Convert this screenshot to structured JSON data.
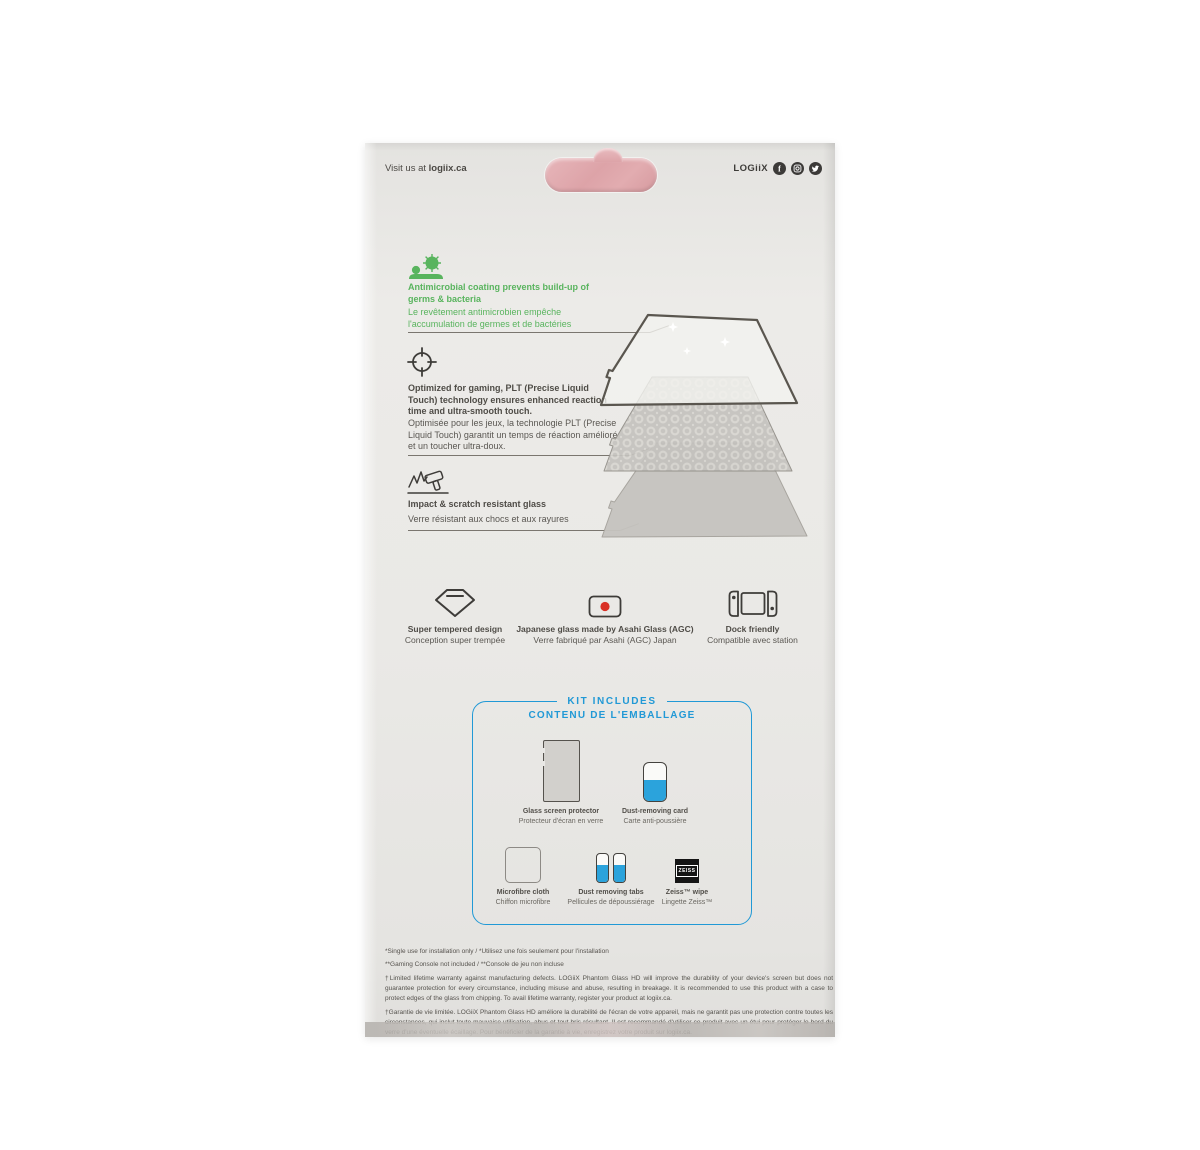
{
  "header": {
    "visit_prefix": "Visit us at ",
    "visit_bold": "logiix.ca",
    "brand": "LOGiiX",
    "social_icons": [
      "facebook-icon",
      "instagram-icon",
      "twitter-icon"
    ]
  },
  "hang_tab": {
    "shape": "pink die-cut hang tab",
    "color": "#dda3a8"
  },
  "features": [
    {
      "icon": "germs-icon",
      "en": "Antimicrobial coating prevents build-up of germs & bacteria",
      "fr": "Le revêtement antimicrobien empêche l'accumulation de germes et de bactéries"
    },
    {
      "icon": "crosshair-icon",
      "en": "Optimized for gaming, PLT (Precise Liquid Touch) technology ensures enhanced reaction time and ultra-smooth touch.",
      "fr": "Optimisée pour les jeux, la technologie PLT (Precise Liquid Touch) garantit un temps de réaction amélioré et un toucher ultra-doux."
    },
    {
      "icon": "impact-hammer-icon",
      "en": "Impact & scratch resistant glass",
      "fr": "Verre résistant aux chocs et aux rayures"
    }
  ],
  "diagram": {
    "description": "three stacked glass layers in perspective",
    "layers": [
      "clear top glass with sparkles",
      "patterned adhesive layer",
      "base glass layer"
    ]
  },
  "badges": [
    {
      "icon": "diamond-icon",
      "en": "Super tempered design",
      "fr": "Conception super trempée"
    },
    {
      "icon": "japan-flag-icon",
      "en": "Japanese glass made by Asahi Glass (AGC)",
      "fr": "Verre fabriqué par Asahi (AGC) Japan"
    },
    {
      "icon": "switch-dock-icon",
      "en": "Dock friendly",
      "fr": "Compatible avec station"
    }
  ],
  "kit": {
    "title_en": "KIT INCLUDES",
    "title_fr": "CONTENU DE L'EMBALLAGE",
    "items": [
      {
        "icon": "glass-protector-icon",
        "en": "Glass screen protector",
        "fr": "Protecteur d'écran en verre"
      },
      {
        "icon": "dust-card-icon",
        "en": "Dust-removing card",
        "fr": "Carte anti-poussière"
      },
      {
        "icon": "microfibre-cloth-icon",
        "en": "Microfibre cloth",
        "fr": "Chiffon microfibre"
      },
      {
        "icon": "dust-tabs-icon",
        "en": "Dust removing tabs",
        "fr": "Pellicules de dépoussiérage"
      },
      {
        "icon": "zeiss-wipe-icon",
        "en": "Zeiss™ wipe",
        "fr": "Lingette Zeiss™"
      }
    ],
    "zeiss_logo": "ZEISS"
  },
  "legal": {
    "line1": "*Single use for installation only / *Utilisez une fois seulement pour l'installation",
    "line2": "**Gaming Console not included / **Console de jeu non incluse",
    "warranty_en": "†Limited lifetime warranty against manufacturing defects. LOGiiX Phantom Glass HD will improve the durability of your device's screen but does not guarantee protection for every circumstance, including misuse and abuse, resulting in breakage. It is recommended to use this product with a case to protect edges of the glass from chipping. To avail lifetime warranty, register your product at logiix.ca.",
    "warranty_fr": "†Garantie de vie limitée. LOGiiX Phantom Glass HD améliore la durabilité de l'écran de votre appareil, mais ne garantit pas une protection contre toutes les circonstances, qui inclut toute mauvaise utilisation, abus et tout bris résultant. Il est recommandé d'utiliser ce produit avec un étui pour protéger le bord du verre d'une éventuelle écaillage. Pour bénéficier de la garantie à vie, enregistrez votre produit sur logiix.ca."
  },
  "colors": {
    "package": "#e9e8e5",
    "green": "#59b45e",
    "blue": "#2199d6",
    "flag_red": "#d93025",
    "pink_tab": "#dda3a8",
    "ink": "#4b4844"
  }
}
